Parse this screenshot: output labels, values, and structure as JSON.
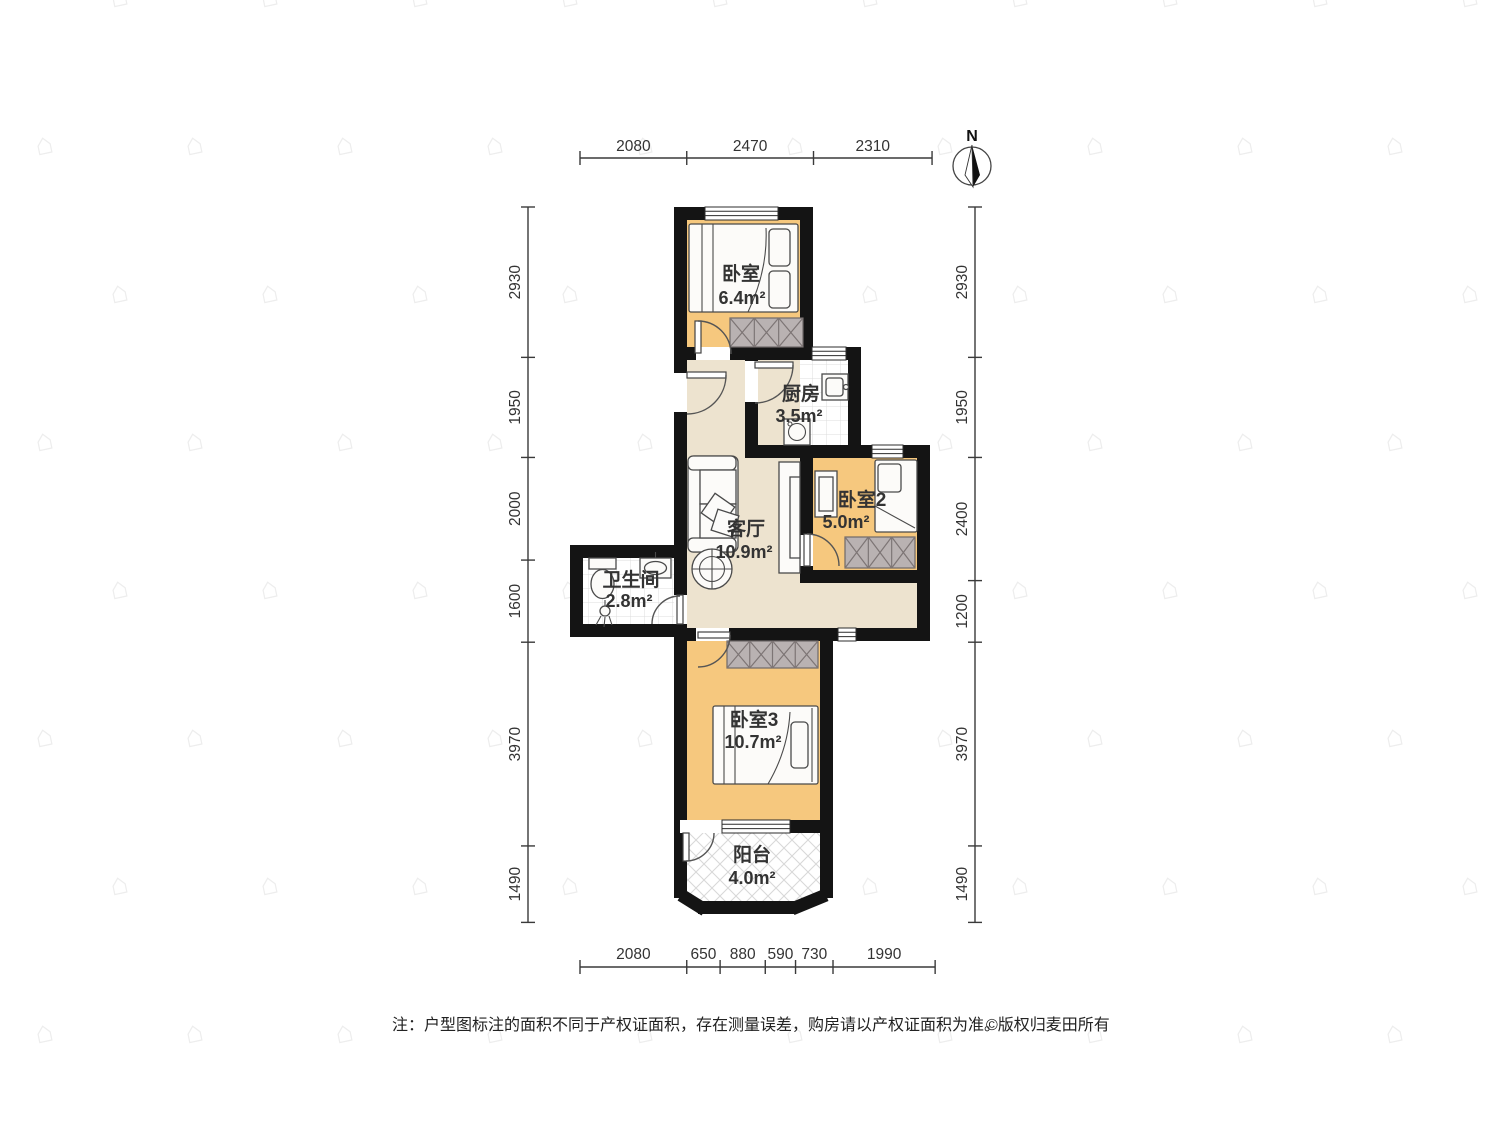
{
  "compass": {
    "north_label": "N"
  },
  "rooms": {
    "bedroom1": {
      "name": "卧室",
      "area": "6.4m²"
    },
    "kitchen": {
      "name": "厨房",
      "area": "3.5m²"
    },
    "bedroom2": {
      "name": "卧室2",
      "area": "5.0m²"
    },
    "living_room": {
      "name": "客厅",
      "area": "10.9m²"
    },
    "bathroom": {
      "name": "卫生间",
      "area": "2.8m²"
    },
    "bedroom3": {
      "name": "卧室3",
      "area": "10.7m²"
    },
    "balcony": {
      "name": "阳台",
      "area": "4.0m²"
    }
  },
  "dimensions_mm": {
    "top": [
      "2080",
      "2470",
      "2310"
    ],
    "bottom": [
      "2080",
      "650",
      "880",
      "590",
      "730",
      "1990"
    ],
    "left": [
      "2930",
      "1950",
      "2000",
      "1600",
      "3970",
      "1490"
    ],
    "right": [
      "2930",
      "1950",
      "2400",
      "1200",
      "3970",
      "1490"
    ]
  },
  "footer": {
    "note": "注：户型图标注的面积不同于产权证面积，存在测量误差，购房请以产权证面积为准。",
    "copyright": "©版权归麦田所有"
  },
  "watermark": {
    "glyph": "⌂"
  },
  "colors": {
    "wall": "#141414",
    "bedroom_floor": "#f6c87e",
    "hall_floor": "#ede3cf",
    "wardrobe": "#b9b2b2",
    "dim_text": "#333333"
  }
}
